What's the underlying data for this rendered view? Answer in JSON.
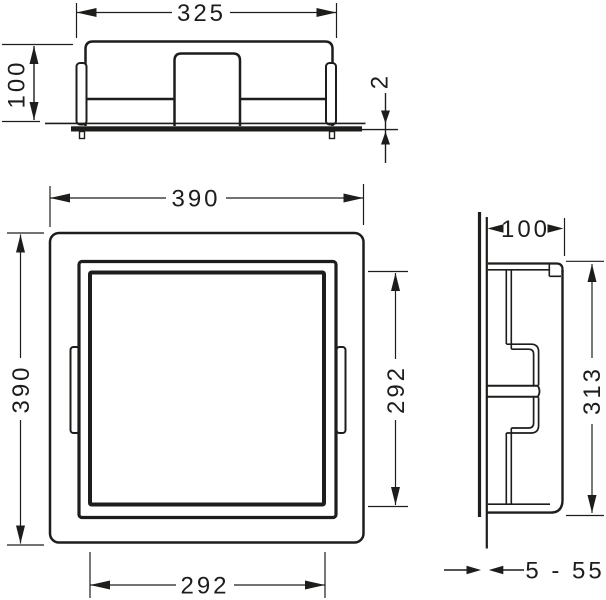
{
  "drawing": {
    "type": "technical-dimension-drawing",
    "background": "#ffffff",
    "line_color": "#1d1d1b",
    "views": {
      "top_view": {
        "dim_width": "325",
        "dim_depth": "100",
        "dim_flange_offset": "2"
      },
      "front_view": {
        "dim_outer_width": "390",
        "dim_outer_height": "390",
        "dim_inner_height": "292",
        "dim_inner_width": "292"
      },
      "side_view": {
        "dim_depth": "100",
        "dim_height": "313",
        "dim_install_range": "5 - 55"
      }
    }
  }
}
